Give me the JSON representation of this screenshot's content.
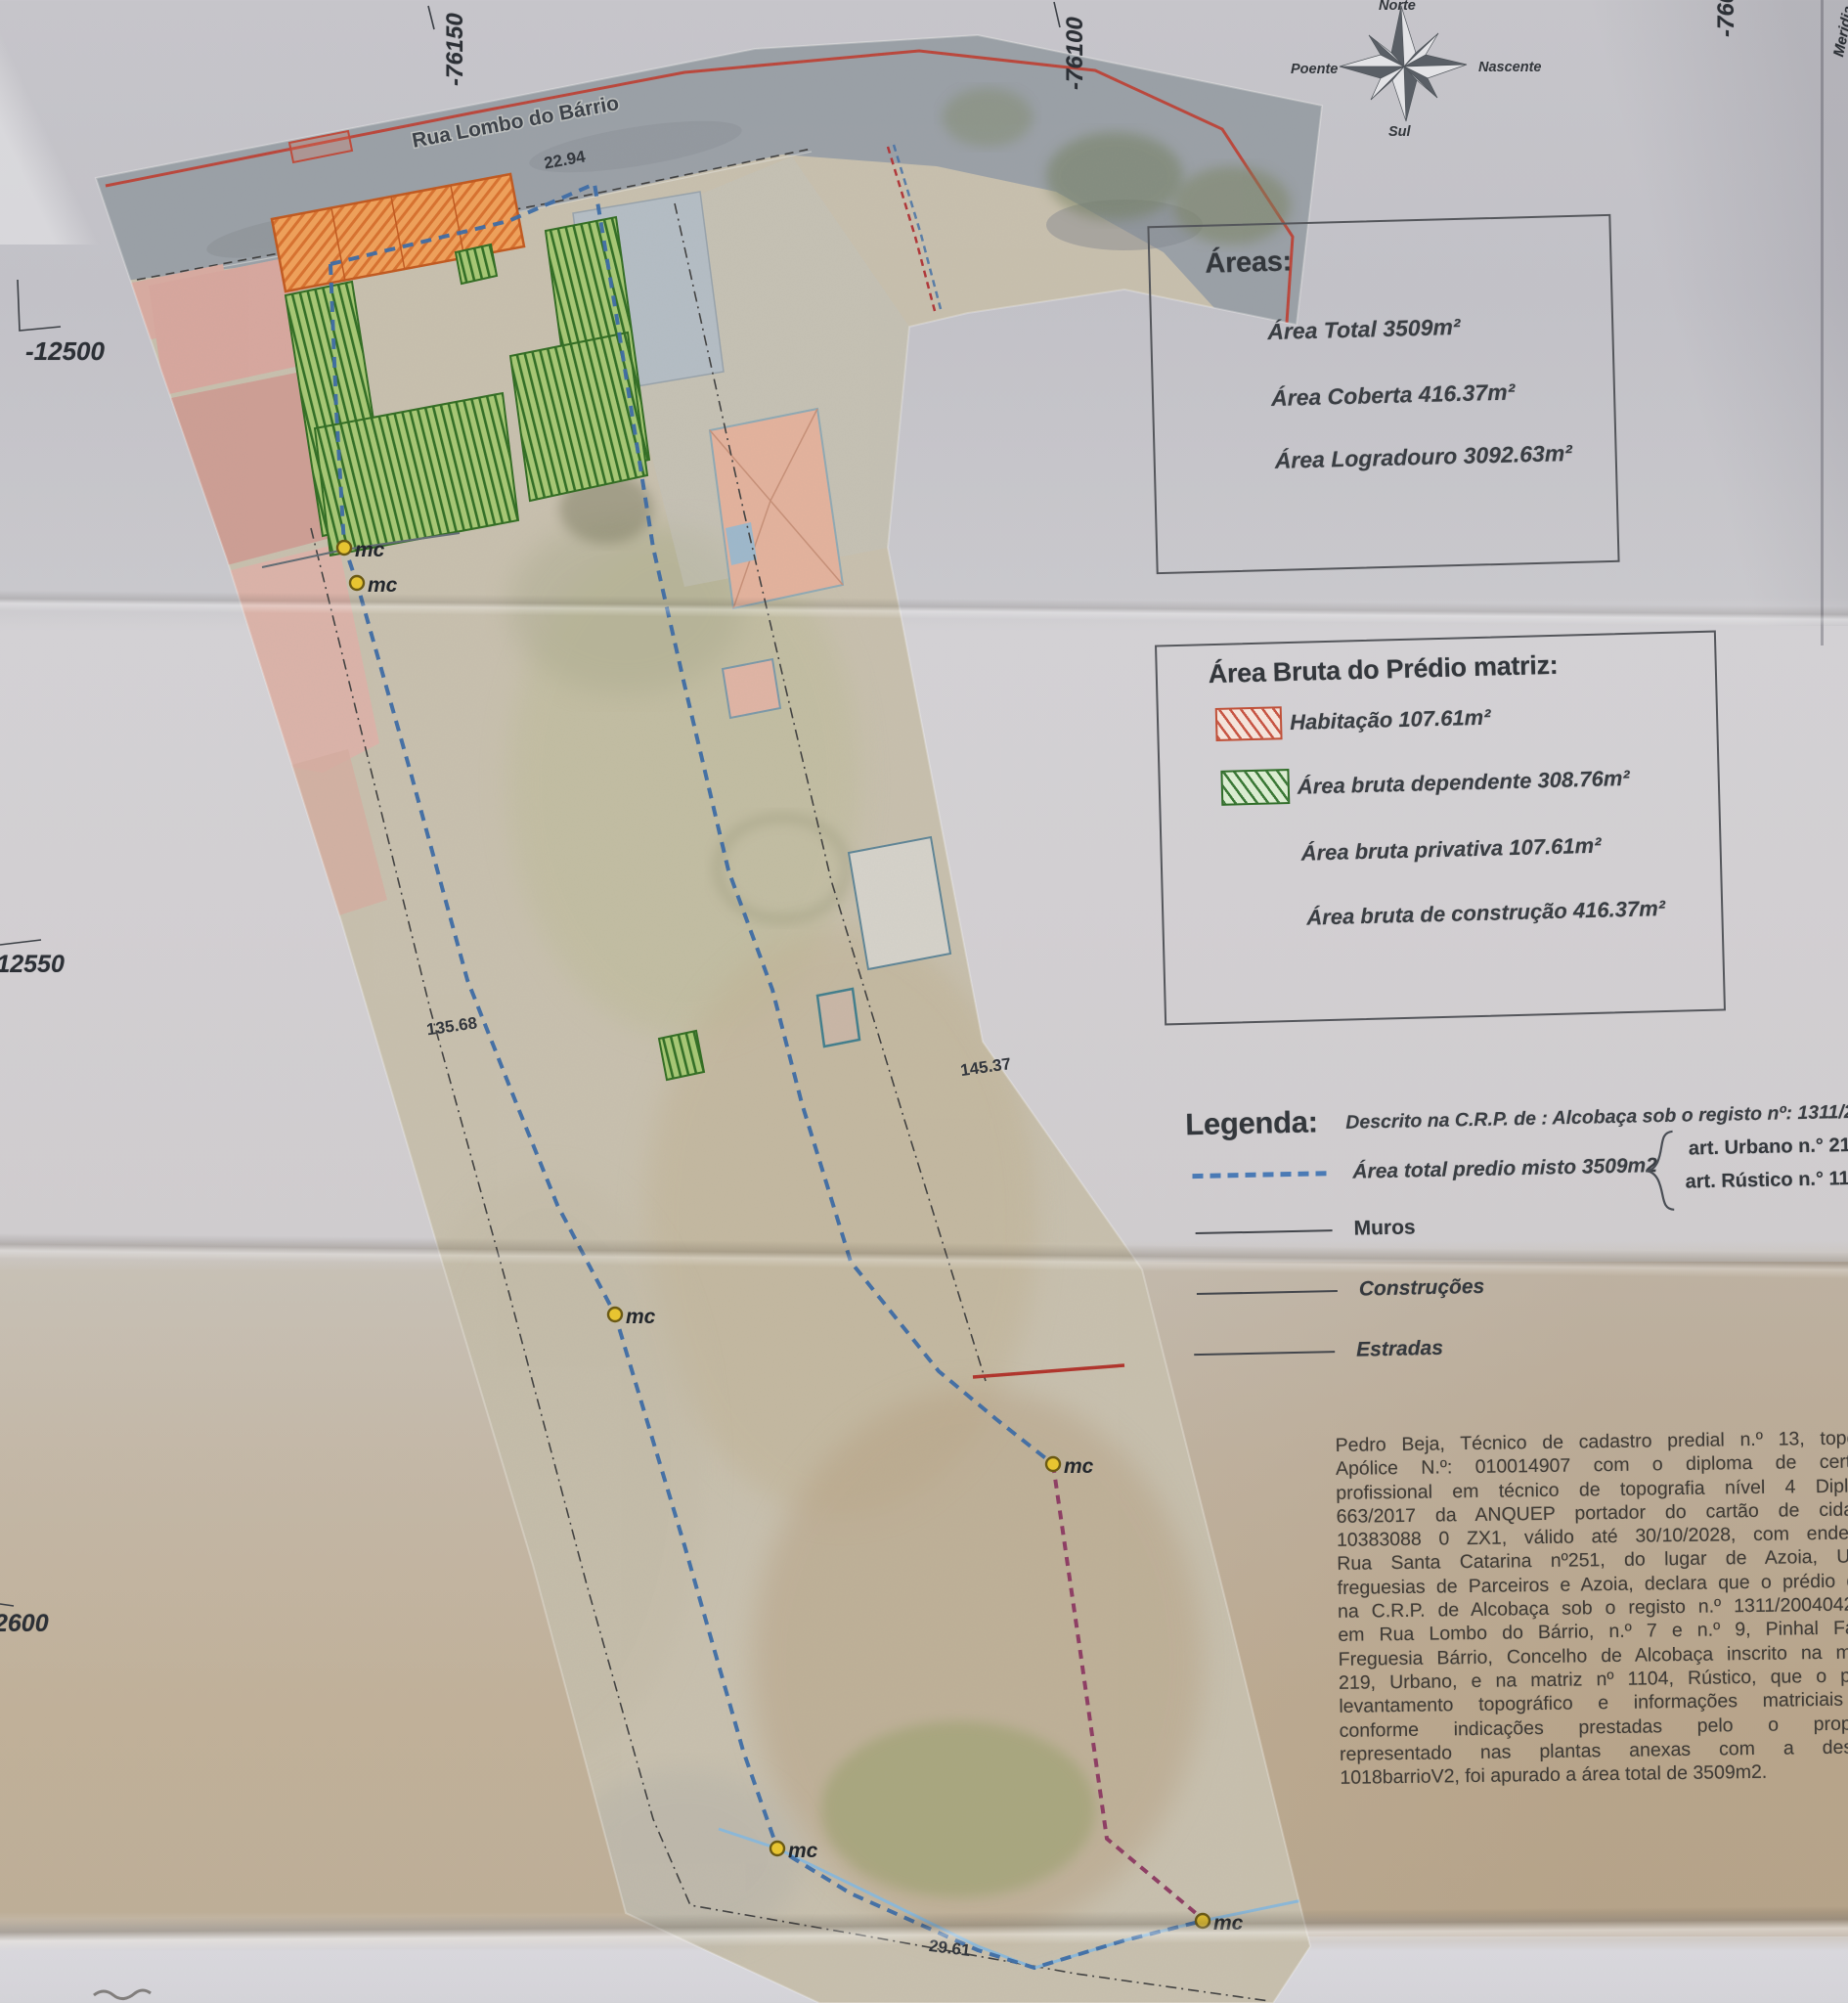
{
  "compass": {
    "north": "Norte",
    "east": "Nascente",
    "south": "Sul",
    "west": "Poente"
  },
  "grid": {
    "x1": "-76150",
    "x2": "-76100",
    "x3": "-760",
    "y1": "-12500",
    "y2": "-12550",
    "y3": "2600",
    "edge_note": "Meridia"
  },
  "map": {
    "street": "Rua Lombo do Bárrio",
    "front_width": "22.94",
    "left_length": "135.68",
    "right_length": "145.37",
    "bottom_width": "29.61",
    "marker": "mc"
  },
  "areas_box": {
    "title": "Áreas:",
    "total": "Área Total 3509m²",
    "covered": "Área  Coberta 416.37m²",
    "yard": "Área Logradouro 3092.63m²"
  },
  "gross_box": {
    "title": "Área Bruta do Prédio matriz:",
    "habitacao": "Habitação 107.61m²",
    "dependente": "Área bruta dependente 308.76m²",
    "privativa": "Área bruta privativa 107.61m²",
    "construcao": "Área bruta de construção 416.37m²"
  },
  "legend": {
    "title": "Legenda:",
    "description": "Descrito na C.R.P. de : Alcobaça sob o registo nº: 1311/2004",
    "boundary": "Área total predio misto 3509m2",
    "art_urbano": "art.  Urbano n.° 219",
    "art_rustico": "art.  Rústico n.° 1104",
    "muros": "Muros",
    "construcoes": "Construções",
    "estradas": "Estradas"
  },
  "declaration": {
    "lines": [
      "Pedro Beja, Técnico de cadastro predial n.º 13, topógra",
      "Apólice N.º: 010014907 com o diploma de certifica",
      "profissional em técnico de topografia nível 4 Diploma",
      "663/2017 da ANQUEP portador do cartão de cidadão",
      "10383088 0 ZX1, válido até 30/10/2028, com endereço",
      "Rua Santa Catarina nº251, do lugar de Azoia, União",
      "freguesias de Parceiros e Azoia, declara que o prédio desc",
      "na C.R.P. de Alcobaça sob o registo n.º 1311/20040423 s",
      "em Rua Lombo do Bárrio, n.º 7 e n.º 9, Pinhal Fanhe",
      "Freguesia Bárrio, Concelho de Alcobaça inscrito na matriz",
      "219, Urbano, e na matriz nº 1104, Rústico,  que o prese",
      "levantamento topográfico e informações matriciais es",
      "conforme indicações prestadas pelo o proprietá",
      "representado nas plantas anexas com a designa",
      "1018barrioV2, foi apurado a área total de 3509m2."
    ]
  }
}
